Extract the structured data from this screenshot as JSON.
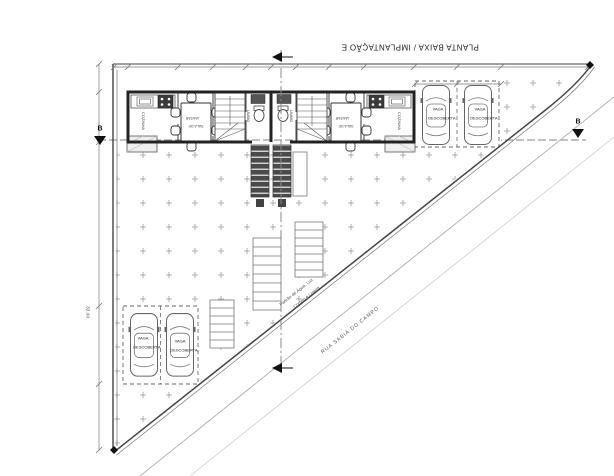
{
  "colors": {
    "line_dark": "#2b2b2b",
    "line_mid": "#666666",
    "line_light": "#aaaaaa",
    "fill_dark": "#4a4a4a",
    "hatch_mark": "#9a9a9a",
    "text": "#333333"
  },
  "drawing": {
    "title": "PLANTA BAIXA / IMPLANTAÇÃO E",
    "street": {
      "name": "RUA SABIÁ DO CAMPO",
      "utilities_line1": "Padrão de Água, Luz,",
      "utilities_line2": "Correio e Lixeira"
    },
    "sections": {
      "b_left": "B",
      "b_right": "B"
    },
    "dimensions": {
      "left_total": "33.00"
    },
    "rooms": {
      "kitchen_left": "COZINHA",
      "kitchen_right": "COZINHA",
      "dining_line1": "SALA DE",
      "dining_line2": "JANTAR",
      "bath_left": "LAVABO",
      "bath_right": "LAVABO"
    },
    "parking": {
      "stalls": [
        {
          "line1": "VAGA",
          "line2": "DESCOBERTA"
        },
        {
          "line1": "VAGA",
          "line2": "DESCOBERTA"
        },
        {
          "line1": "VAGA",
          "line2": "DESCOBERTA"
        },
        {
          "line1": "VAGA",
          "line2": "DESCOBERTA"
        }
      ]
    }
  }
}
